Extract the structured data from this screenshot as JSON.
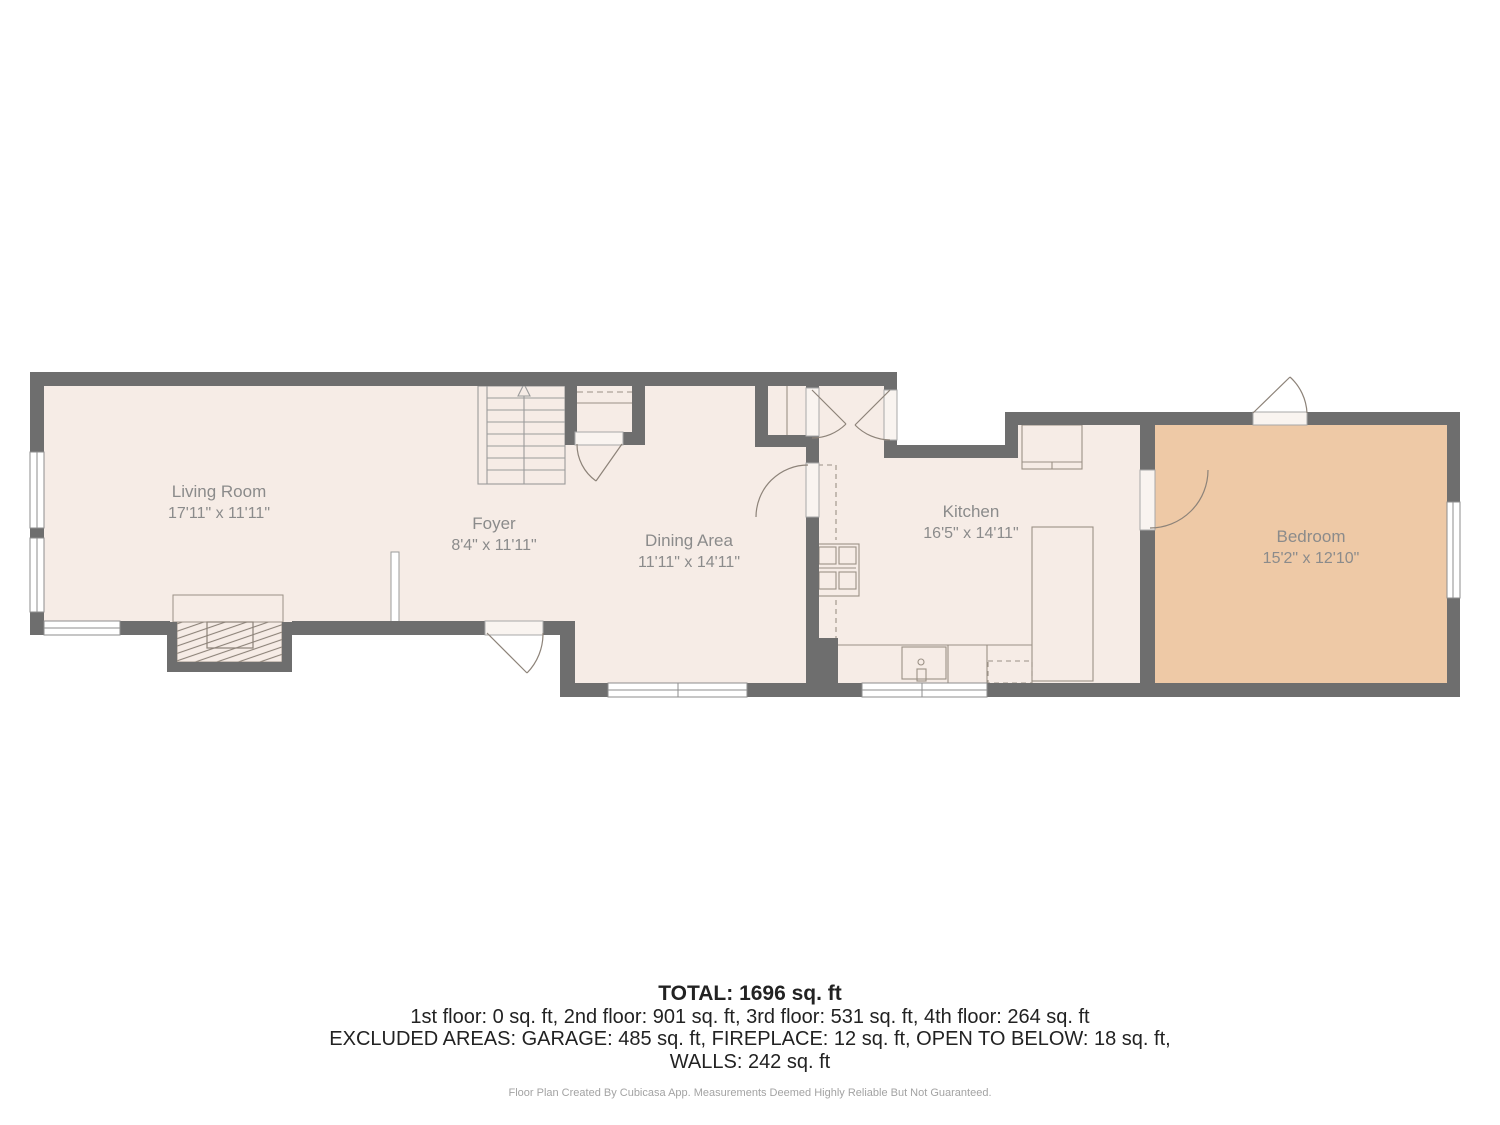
{
  "plan": {
    "rooms": [
      {
        "id": "living-room",
        "name": "Living Room",
        "dims": "17'11\" x 11'11\""
      },
      {
        "id": "foyer",
        "name": "Foyer",
        "dims": "8'4\" x 11'11\""
      },
      {
        "id": "dining-area",
        "name": "Dining Area",
        "dims": "11'11\" x 14'11\""
      },
      {
        "id": "kitchen",
        "name": "Kitchen",
        "dims": "16'5\" x 14'11\""
      },
      {
        "id": "bedroom",
        "name": "Bedroom",
        "dims": "15'2\" x 12'10\""
      }
    ]
  },
  "summary": {
    "total": "TOTAL: 1696 sq. ft",
    "floors": "1st floor: 0 sq. ft, 2nd floor: 901 sq. ft, 3rd floor: 531 sq. ft, 4th floor: 264 sq. ft",
    "excluded_line1": "EXCLUDED AREAS: GARAGE: 485 sq. ft, FIREPLACE: 12 sq. ft, OPEN TO BELOW: 18 sq. ft,",
    "excluded_line2": "WALLS: 242 sq. ft",
    "disclaimer": "Floor Plan Created By Cubicasa App. Measurements Deemed Highly Reliable But Not Guaranteed."
  },
  "colors": {
    "wall": "#6e6e6e",
    "floor": "#f6ece6",
    "bedroom_floor": "#eec9a6",
    "line": "#9b9186",
    "label_text": "#8b8b8b",
    "summary_text": "#222222",
    "disclaimer_text": "#a3a3a3"
  }
}
